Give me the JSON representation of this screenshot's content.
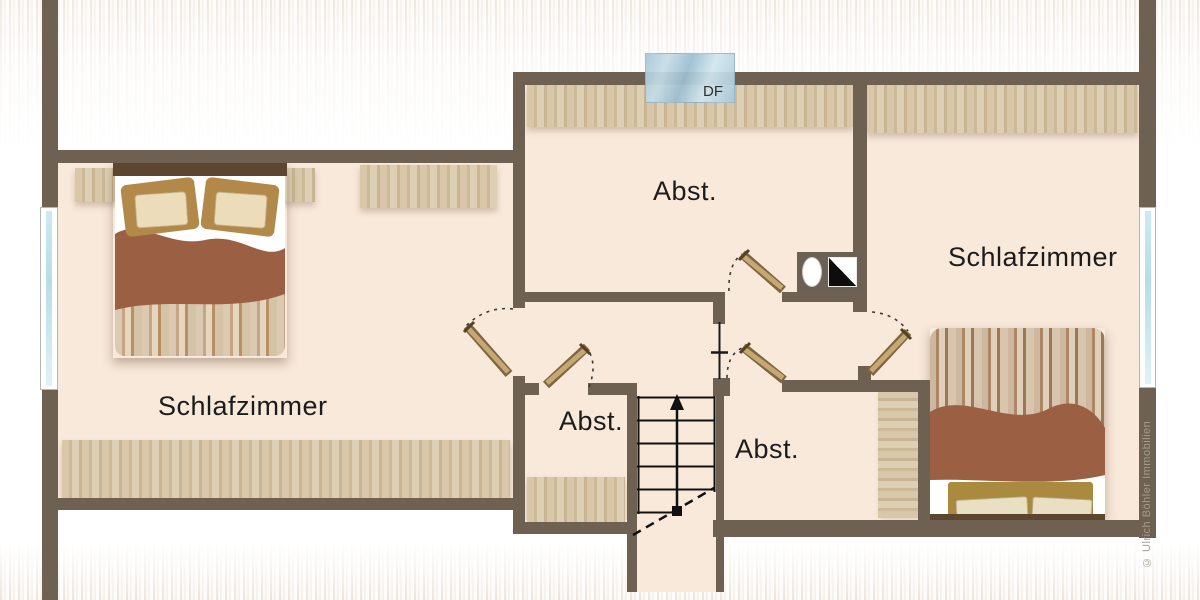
{
  "floorplan": {
    "labels": {
      "bedroom_left": "Schlafzimmer",
      "bedroom_right": "Schlafzimmer",
      "storage_top": "Abst.",
      "storage_lower_left": "Abst.",
      "storage_lower_right": "Abst.",
      "roof_window": "DF"
    },
    "copyright": "© Ulrich Böhler Immobilien",
    "colors": {
      "wall": "#6e6152",
      "floor": "#f9e9da",
      "wood_band": "#d5c4a5",
      "door_leaf": "#bb9c66",
      "blanket": "#9b5f44",
      "roof_window_glass": "#b0cfdf",
      "side_window_glass": "#c4e3ee",
      "background_stripe": "#e9e1d6",
      "label_text": "#1c1c1c",
      "copyright_text": "#a49c8f"
    }
  }
}
